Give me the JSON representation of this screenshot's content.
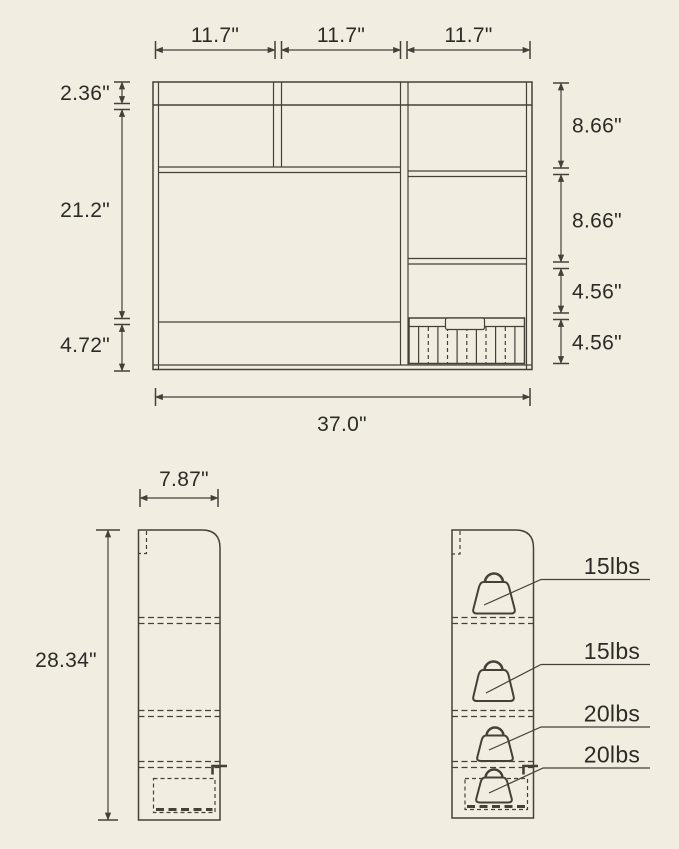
{
  "diagram": {
    "front_view": {
      "segment_widths": [
        "11.7\"",
        "11.7\"",
        "11.7\""
      ],
      "left_heights": [
        "2.36\"",
        "21.2\"",
        "4.72\""
      ],
      "right_heights": [
        "8.66\"",
        "8.66\"",
        "4.56\"",
        "4.56\""
      ],
      "total_width": "37.0\""
    },
    "side_view": {
      "depth": "7.87\"",
      "height": "28.34\""
    },
    "shelf_weight_limits": [
      "15lbs",
      "15lbs",
      "20lbs",
      "20lbs"
    ],
    "colors": {
      "background": "#f2ede1",
      "line": "#454139",
      "text": "#2c2b26"
    }
  }
}
